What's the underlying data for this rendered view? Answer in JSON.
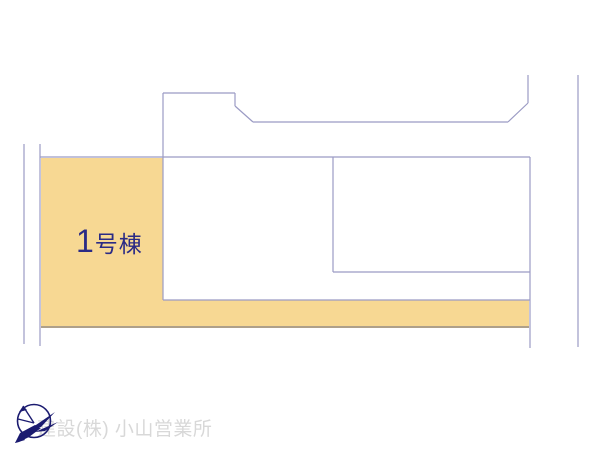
{
  "scene": {
    "type": "real-estate-site-plan",
    "background_color": "#ffffff",
    "boundary_line_color": "#9B9BC4"
  },
  "plots": {
    "plot1": {
      "number": "1",
      "suffix": "号棟",
      "label": "1号棟",
      "fill_color": "#F7D893",
      "bottom_border_color": "#A3927A",
      "label_color": "#2B2B85"
    }
  },
  "watermark": {
    "text": "建設(株) 小山営業所",
    "text_color": "#D8D8D8",
    "logo": "compass-bird-logo",
    "logo_color": "#1B1B70"
  }
}
